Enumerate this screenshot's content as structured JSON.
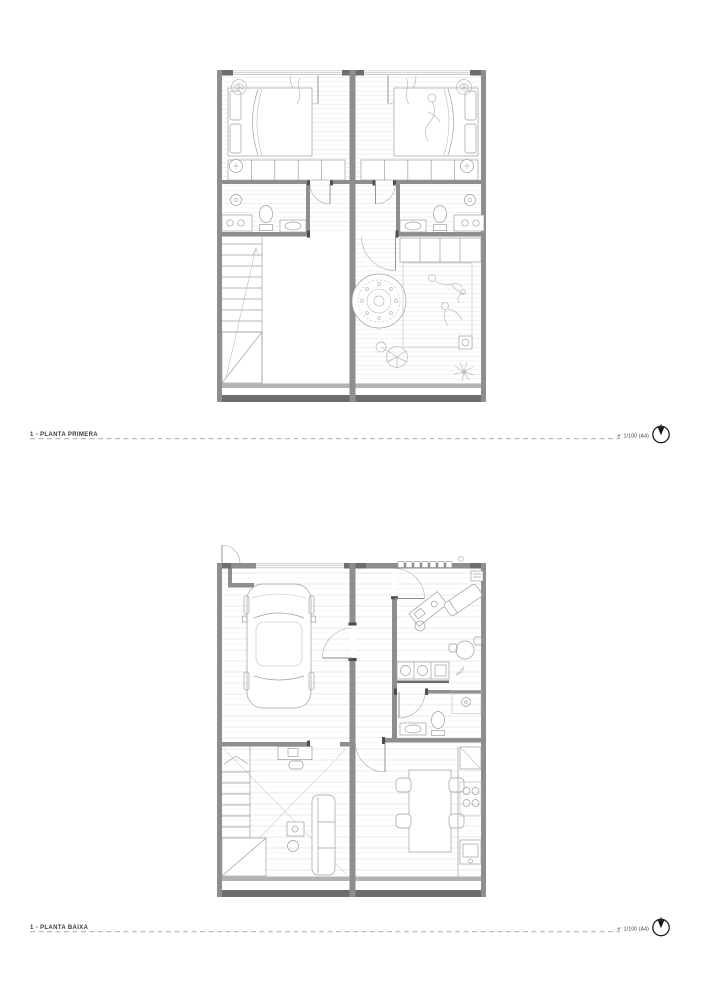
{
  "sheets": [
    {
      "id": "first-floor",
      "title": "1 - PLANTA PRIMERA",
      "scale_note": "e: 1/100 (A4)",
      "icon": "north-arrow-icon"
    },
    {
      "id": "ground-floor",
      "title": "1 - PLANTA BAIXA",
      "scale_note": "e: 1/100 (A4)",
      "icon": "north-arrow-icon"
    }
  ],
  "colors": {
    "background": "#ffffff",
    "wall": "#8e8e8e",
    "wall_dark": "#6d6d6d",
    "furniture_line": "#9f9f9f",
    "hatch_line": "#dedede",
    "label_text": "#3a3a3a",
    "dashed_rule": "#7a7a7a",
    "north_icon": "#141414"
  }
}
